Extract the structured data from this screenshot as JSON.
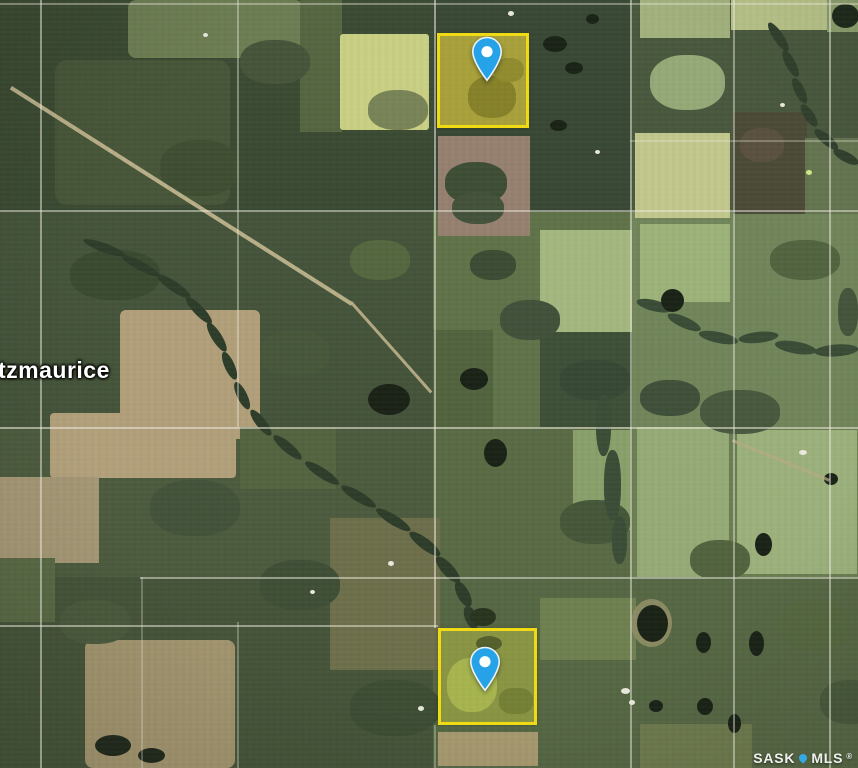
{
  "map": {
    "place_label": "tzmaurice",
    "watermark": {
      "part1": "SASK",
      "part2": "MLS",
      "reg": "®",
      "pin_color": "#35a9e1"
    },
    "colors": {
      "base": "#47573c",
      "grid_line": "#eceadd",
      "parcel_border": "#f0da14",
      "parcel_fill_1": "rgba(208,190,20,0.25)",
      "parcel_fill_2": "rgba(190,195,40,0.18)",
      "pin_fill": "#26a2e8",
      "pin_stroke": "#e8f4fb",
      "pin_dot": "#ffffff"
    },
    "patches": [
      [
        0,
        0,
        433,
        212,
        "#3b4a32",
        "",
        0,
        1
      ],
      [
        0,
        212,
        433,
        216,
        "#44543a",
        "",
        0,
        1
      ],
      [
        433,
        0,
        197,
        212,
        "#394834",
        "",
        0,
        1
      ],
      [
        630,
        0,
        228,
        212,
        "#48583d",
        "",
        0,
        1
      ],
      [
        433,
        212,
        197,
        215,
        "#5f7248",
        "",
        0,
        1
      ],
      [
        630,
        212,
        228,
        215,
        "#71855a",
        "",
        0,
        1
      ],
      [
        0,
        427,
        433,
        150,
        "#4c5b3e",
        "",
        0,
        1
      ],
      [
        433,
        427,
        197,
        150,
        "#596a44",
        "",
        0,
        1
      ],
      [
        630,
        427,
        228,
        150,
        "#6b7e52",
        "",
        0,
        1
      ],
      [
        0,
        577,
        433,
        191,
        "#455439",
        "",
        0,
        1
      ],
      [
        433,
        577,
        425,
        191,
        "#566744",
        "",
        0,
        1
      ],
      [
        128,
        0,
        175,
        58,
        "#6d7d53",
        "8px",
        0,
        1
      ],
      [
        55,
        60,
        175,
        145,
        "#475638",
        "12px",
        0,
        1
      ],
      [
        300,
        0,
        42,
        132,
        "#566641",
        "",
        0,
        1
      ],
      [
        340,
        34,
        89,
        96,
        "#c9cf83",
        "3px",
        0,
        1
      ],
      [
        640,
        0,
        90,
        38,
        "#a2b17d",
        "",
        0,
        1
      ],
      [
        731,
        0,
        96,
        30,
        "#b7c288",
        "",
        0,
        1
      ],
      [
        827,
        0,
        31,
        32,
        "#8c9e6d",
        "",
        0,
        1
      ],
      [
        438,
        136,
        92,
        100,
        "#96806f",
        "",
        0,
        1
      ],
      [
        635,
        133,
        95,
        85,
        "#c2c78d",
        "",
        0,
        1
      ],
      [
        733,
        112,
        74,
        102,
        "#4b4a37",
        "",
        0,
        1
      ],
      [
        805,
        138,
        53,
        76,
        "#657450",
        "",
        0,
        1
      ],
      [
        540,
        230,
        92,
        102,
        "#a3b77f",
        "",
        0,
        1
      ],
      [
        640,
        224,
        90,
        78,
        "#9cb279",
        "",
        0,
        1
      ],
      [
        540,
        332,
        92,
        95,
        "#3e5037",
        "",
        0,
        1
      ],
      [
        637,
        427,
        92,
        150,
        "#95aa76",
        "",
        0,
        1
      ],
      [
        737,
        430,
        120,
        144,
        "#9bb07b",
        "",
        0,
        1
      ],
      [
        573,
        430,
        57,
        100,
        "#89a06b",
        "",
        0,
        1
      ],
      [
        50,
        413,
        186,
        65,
        "#b1a07a",
        "4px",
        0,
        1
      ],
      [
        0,
        477,
        99,
        86,
        "#a49775",
        "",
        0,
        1
      ],
      [
        120,
        310,
        140,
        129,
        "#b09f79",
        "6px",
        0,
        1
      ],
      [
        330,
        518,
        110,
        152,
        "#6d6f4b",
        "",
        0,
        1
      ],
      [
        85,
        640,
        150,
        128,
        "#a1946e",
        "8px",
        0,
        1
      ],
      [
        438,
        732,
        100,
        34,
        "#a7996f",
        "",
        0,
        1
      ],
      [
        640,
        724,
        112,
        44,
        "#6d794d",
        "",
        0,
        1
      ],
      [
        240,
        427,
        96,
        62,
        "#546440",
        "",
        0,
        1
      ],
      [
        540,
        598,
        96,
        62,
        "#6f8050",
        "",
        0,
        1
      ],
      [
        0,
        558,
        55,
        64,
        "#596944",
        "",
        0,
        1
      ],
      [
        433,
        330,
        60,
        97,
        "#52643e",
        "",
        0,
        1
      ],
      [
        650,
        55,
        75,
        55,
        "#95a877",
        "45%",
        0,
        1
      ],
      [
        445,
        162,
        62,
        42,
        "#3e4e35",
        "45%",
        0,
        1
      ],
      [
        452,
        192,
        52,
        32,
        "#43523a",
        "45%",
        0,
        1
      ],
      [
        740,
        128,
        44,
        34,
        "#5a513f",
        "45%",
        0,
        1
      ],
      [
        838,
        288,
        20,
        48,
        "#44553c",
        "45%",
        0,
        1
      ],
      [
        470,
        250,
        46,
        30,
        "#3c4c34",
        "45%",
        0,
        1
      ],
      [
        500,
        300,
        60,
        40,
        "#41513a",
        "45%",
        0,
        1
      ],
      [
        560,
        360,
        70,
        40,
        "#374834",
        "45%",
        0,
        1
      ],
      [
        640,
        380,
        60,
        36,
        "#3f5039",
        "45%",
        0,
        1
      ],
      [
        700,
        390,
        80,
        44,
        "#48593e",
        "45%",
        0,
        1
      ],
      [
        770,
        240,
        70,
        40,
        "#52643f",
        "45%",
        0,
        1
      ],
      [
        70,
        250,
        90,
        50,
        "#3a4a31",
        "45%",
        0,
        1
      ],
      [
        260,
        330,
        70,
        46,
        "#47573a",
        "45%",
        0,
        1
      ],
      [
        350,
        240,
        60,
        40,
        "#55673f",
        "45%",
        0,
        1
      ],
      [
        150,
        480,
        90,
        56,
        "#43533a",
        "45%",
        0,
        1
      ],
      [
        260,
        560,
        80,
        50,
        "#3f4f36",
        "45%",
        0,
        1
      ],
      [
        60,
        600,
        70,
        44,
        "#4a5a3c",
        "45%",
        0,
        1
      ],
      [
        350,
        680,
        90,
        56,
        "#3d4d34",
        "45%",
        0,
        1
      ],
      [
        560,
        500,
        70,
        44,
        "#465739",
        "45%",
        0,
        1
      ],
      [
        780,
        600,
        70,
        50,
        "#55673f",
        "45%",
        0,
        1
      ],
      [
        820,
        680,
        60,
        44,
        "#48593b",
        "45%",
        0,
        1
      ],
      [
        690,
        540,
        60,
        40,
        "#52633e",
        "45%",
        0,
        1
      ],
      [
        160,
        140,
        80,
        56,
        "#3f4e33",
        "45%",
        0,
        1
      ],
      [
        240,
        40,
        70,
        44,
        "#465539",
        "45%",
        0,
        1
      ],
      [
        368,
        90,
        60,
        40,
        "#42513a",
        "45%",
        0,
        0.6
      ],
      [
        85,
        236,
        44,
        9,
        "#2e3c2a",
        "50%",
        20,
        1
      ],
      [
        124,
        252,
        42,
        9,
        "#2e3c2a",
        "50%",
        28,
        1
      ],
      [
        160,
        271,
        40,
        10,
        "#2e3c2a",
        "50%",
        34,
        1
      ],
      [
        190,
        294,
        36,
        10,
        "#2e3c2a",
        "50%",
        46,
        1
      ],
      [
        212,
        320,
        34,
        10,
        "#2e3c2a",
        "50%",
        58,
        1
      ],
      [
        228,
        350,
        30,
        10,
        "#2e3c2a",
        "50%",
        66,
        1
      ],
      [
        240,
        380,
        30,
        10,
        "#2e3c2a",
        "50%",
        64,
        1
      ],
      [
        255,
        407,
        32,
        10,
        "#2e3c2a",
        "50%",
        52,
        1
      ],
      [
        277,
        432,
        36,
        10,
        "#2e3c2a",
        "50%",
        40,
        1
      ],
      [
        308,
        458,
        40,
        10,
        "#2e3c2a",
        "50%",
        33,
        1
      ],
      [
        344,
        482,
        40,
        10,
        "#2e3c2a",
        "50%",
        31,
        1
      ],
      [
        379,
        505,
        40,
        10,
        "#2e3c2a",
        "50%",
        32,
        1
      ],
      [
        413,
        528,
        38,
        11,
        "#2e3c2a",
        "50%",
        37,
        1
      ],
      [
        441,
        553,
        34,
        12,
        "#2e3c2a",
        "50%",
        48,
        1
      ],
      [
        462,
        579,
        28,
        12,
        "#2e3c2a",
        "50%",
        62,
        1
      ],
      [
        472,
        604,
        24,
        12,
        "#2e3c2a",
        "50%",
        68,
        1
      ],
      [
        773,
        20,
        34,
        10,
        "#31402d",
        "50%",
        56,
        1
      ],
      [
        788,
        48,
        30,
        10,
        "#31402d",
        "50%",
        62,
        1
      ],
      [
        798,
        76,
        28,
        10,
        "#31402d",
        "50%",
        64,
        1
      ],
      [
        806,
        102,
        26,
        10,
        "#31402d",
        "50%",
        56,
        1
      ],
      [
        818,
        126,
        30,
        10,
        "#31402d",
        "50%",
        40,
        1
      ],
      [
        836,
        146,
        28,
        10,
        "#31402d",
        "50%",
        28,
        1
      ],
      [
        638,
        296,
        36,
        11,
        "#3a4c36",
        "50%",
        14,
        1
      ],
      [
        670,
        310,
        36,
        11,
        "#3a4c36",
        "50%",
        24,
        1
      ],
      [
        700,
        328,
        40,
        11,
        "#3a4c36",
        "50%",
        12,
        1
      ],
      [
        738,
        334,
        40,
        11,
        "#3a4c36",
        "50%",
        -6,
        1
      ],
      [
        776,
        338,
        42,
        12,
        "#3a4c36",
        "50%",
        10,
        1
      ],
      [
        814,
        346,
        44,
        12,
        "#3a4c36",
        "50%",
        -4,
        1
      ],
      [
        596,
        394,
        15,
        62,
        "#3b4d37",
        "45%",
        0,
        1
      ],
      [
        604,
        450,
        17,
        70,
        "#3b4d37",
        "45%",
        0,
        1
      ],
      [
        612,
        516,
        15,
        48,
        "#3b4d37",
        "45%",
        0,
        1
      ],
      [
        631,
        599,
        41,
        48,
        "#8a8a62",
        "50%",
        0,
        1
      ],
      [
        543,
        36,
        24,
        16,
        "#1b2317",
        "50%",
        0,
        1
      ],
      [
        565,
        62,
        18,
        12,
        "#1b2317",
        "50%",
        0,
        1
      ],
      [
        586,
        14,
        13,
        10,
        "#1b2317",
        "50%",
        0,
        1
      ],
      [
        550,
        120,
        17,
        11,
        "#1b2317",
        "50%",
        0,
        1
      ],
      [
        368,
        384,
        42,
        31,
        "#1b2317",
        "50%",
        0,
        1
      ],
      [
        460,
        368,
        28,
        22,
        "#1b2317",
        "50%",
        0,
        1
      ],
      [
        484,
        439,
        23,
        28,
        "#1b2317",
        "50%",
        0,
        1
      ],
      [
        661,
        289,
        23,
        23,
        "#1b2317",
        "50%",
        0,
        1
      ],
      [
        637,
        605,
        31,
        37,
        "#1b2317",
        "50%",
        0,
        1
      ],
      [
        696,
        632,
        15,
        21,
        "#1b2317",
        "50%",
        0,
        1
      ],
      [
        749,
        631,
        15,
        25,
        "#1b2317",
        "50%",
        0,
        1
      ],
      [
        697,
        698,
        16,
        17,
        "#1b2317",
        "50%",
        0,
        1
      ],
      [
        649,
        700,
        14,
        12,
        "#1b2317",
        "50%",
        0,
        1
      ],
      [
        728,
        714,
        13,
        19,
        "#1b2317",
        "50%",
        0,
        1
      ],
      [
        755,
        533,
        17,
        23,
        "#1b2317",
        "50%",
        0,
        1
      ],
      [
        824,
        473,
        14,
        12,
        "#1b2317",
        "50%",
        0,
        1
      ],
      [
        95,
        735,
        36,
        21,
        "#212b1d",
        "50%",
        0,
        1
      ],
      [
        138,
        748,
        27,
        15,
        "#212b1d",
        "50%",
        0,
        1
      ],
      [
        832,
        4,
        27,
        24,
        "#1f2a1c",
        "50%",
        0,
        1
      ],
      [
        470,
        608,
        26,
        18,
        "#2a351f",
        "50%",
        0,
        1
      ],
      [
        12,
        86,
        404,
        4,
        "#c5b991",
        "",
        32.4,
        0.9
      ],
      [
        352,
        301,
        121,
        3,
        "#bfb38b",
        "",
        48.4,
        0.9
      ],
      [
        733,
        439,
        105,
        3,
        "#b5ab85",
        "",
        22.4,
        0.75
      ],
      [
        388,
        561,
        6,
        5,
        "#e9e9dc",
        "50%",
        0,
        1
      ],
      [
        310,
        590,
        5,
        4,
        "#e9e9dc",
        "50%",
        0,
        1
      ],
      [
        418,
        706,
        6,
        5,
        "#e9e9dc",
        "50%",
        0,
        1
      ],
      [
        621,
        688,
        9,
        6,
        "#e9e9dc",
        "50%",
        0,
        1
      ],
      [
        629,
        700,
        6,
        5,
        "#e9e9dc",
        "50%",
        0,
        1
      ],
      [
        799,
        450,
        8,
        5,
        "#e9e9dc",
        "50%",
        0,
        1
      ],
      [
        780,
        103,
        5,
        4,
        "#e9e9dc",
        "50%",
        0,
        1
      ],
      [
        595,
        150,
        5,
        4,
        "#e9e9dc",
        "50%",
        0,
        1
      ],
      [
        508,
        11,
        6,
        5,
        "#e9e9dc",
        "50%",
        0,
        1
      ],
      [
        203,
        33,
        5,
        4,
        "#e9e9dc",
        "50%",
        0,
        1
      ],
      [
        806,
        170,
        6,
        5,
        "#cfe87e",
        "50%",
        0,
        1
      ],
      [
        438,
        34,
        91,
        94,
        "#9a9648",
        "",
        0,
        1
      ],
      [
        468,
        76,
        48,
        42,
        "#6d6c30",
        "45%",
        0,
        1
      ],
      [
        494,
        58,
        30,
        24,
        "#7b7a37",
        "45%",
        0,
        1
      ],
      [
        439,
        629,
        98,
        95,
        "#7e8b49",
        "",
        0,
        1
      ],
      [
        447,
        658,
        50,
        54,
        "#a2b158",
        "45%",
        0,
        1
      ],
      [
        476,
        636,
        26,
        15,
        "#3d4a2e",
        "50%",
        0,
        1
      ],
      [
        499,
        688,
        34,
        26,
        "#657239",
        "40%",
        0,
        1
      ]
    ],
    "grid": {
      "vertical": [
        {
          "x": 40,
          "y1": 0,
          "y2": 768,
          "o": 0.5
        },
        {
          "x": 141,
          "y1": 577,
          "y2": 768,
          "o": 0.28
        },
        {
          "x": 237,
          "y1": 0,
          "y2": 427,
          "o": 0.4
        },
        {
          "x": 237,
          "y1": 622,
          "y2": 768,
          "o": 0.3
        },
        {
          "x": 434,
          "y1": 0,
          "y2": 628,
          "o": 0.55
        },
        {
          "x": 434,
          "y1": 725,
          "y2": 768,
          "o": 0.3
        },
        {
          "x": 630,
          "y1": 0,
          "y2": 768,
          "o": 0.5
        },
        {
          "x": 733,
          "y1": 0,
          "y2": 768,
          "o": 0.45
        },
        {
          "x": 829,
          "y1": 0,
          "y2": 768,
          "o": 0.5
        }
      ],
      "horizontal": [
        {
          "y": 3,
          "x1": 0,
          "x2": 858,
          "o": 0.4
        },
        {
          "y": 140,
          "x1": 630,
          "x2": 858,
          "o": 0.3
        },
        {
          "y": 210,
          "x1": 0,
          "x2": 858,
          "o": 0.5
        },
        {
          "y": 427,
          "x1": 0,
          "x2": 858,
          "o": 0.55
        },
        {
          "y": 577,
          "x1": 140,
          "x2": 858,
          "o": 0.5
        },
        {
          "y": 625,
          "x1": 0,
          "x2": 438,
          "o": 0.5
        }
      ]
    },
    "parcels": [
      {
        "x": 437,
        "y": 33,
        "w": 92,
        "h": 95,
        "fill": "rgba(208,190,20,0.25)"
      },
      {
        "x": 438,
        "y": 628,
        "w": 99,
        "h": 97,
        "fill": "rgba(190,195,40,0.18)"
      }
    ],
    "pins": [
      {
        "x": 471,
        "y": 36,
        "w": 32,
        "h": 46
      },
      {
        "x": 469,
        "y": 646,
        "w": 32,
        "h": 46
      }
    ]
  }
}
